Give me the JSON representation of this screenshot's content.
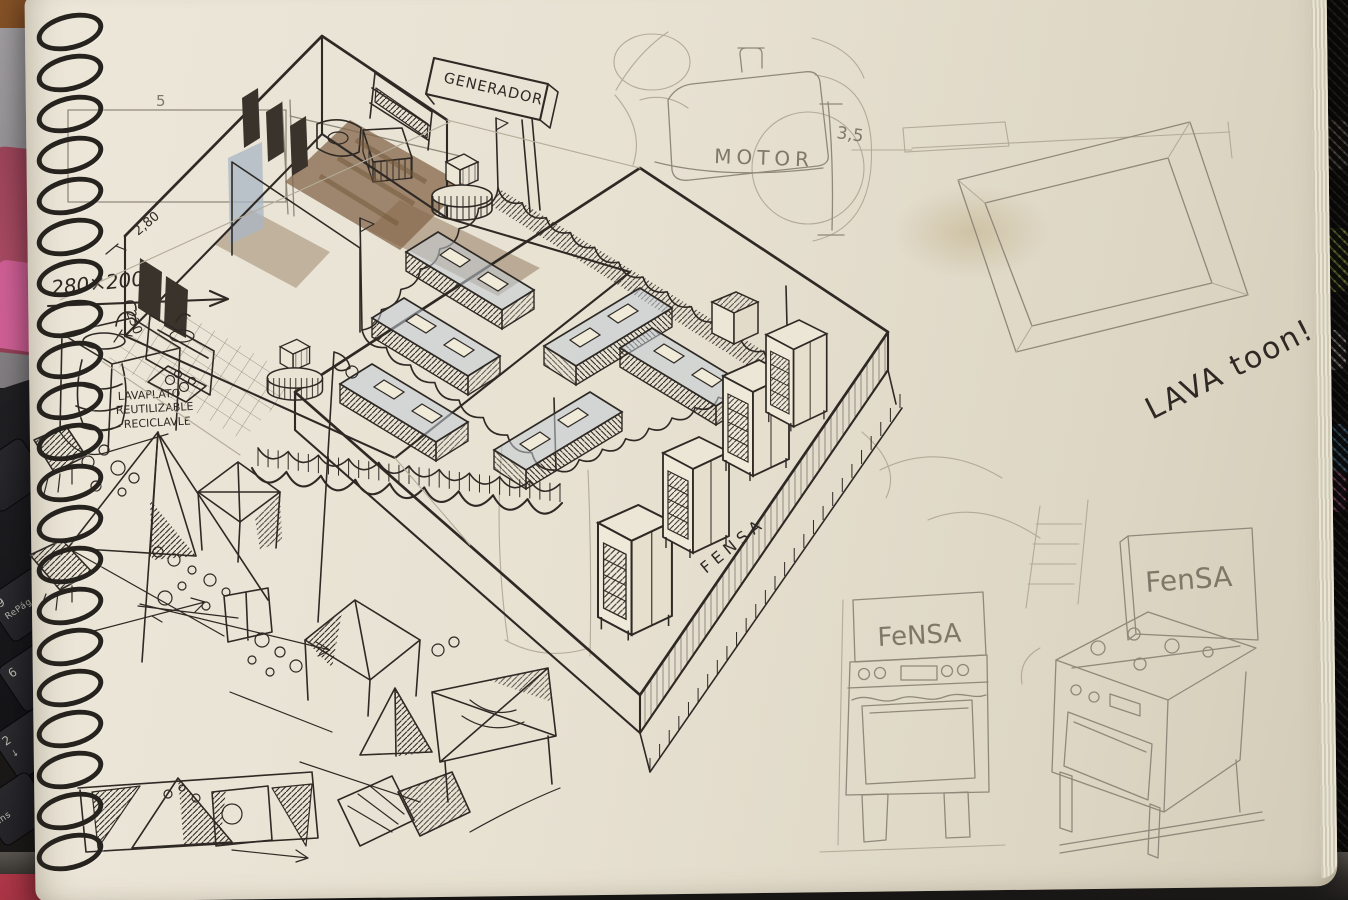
{
  "photo": {
    "keyboard": {
      "keys": [
        {
          "top": "9",
          "bottom": "RePág"
        },
        {
          "top": "6",
          "bottom": ""
        },
        {
          "top": "2",
          "bottom": "↓"
        },
        {
          "top": "",
          "bottom": "Ins"
        }
      ]
    },
    "colors": {
      "page": "#e7e1d2",
      "ink": "#2e2924",
      "pencil": "#8f897b",
      "marker_brown": "#84664a",
      "marker_blue": "#a9b6c4",
      "wood_shelf": "#7b4d24",
      "pink_object": "#a84a62",
      "keyboard": "#1b1b1e",
      "mesh_green": "#9dab3f",
      "desk": "#2a2725"
    }
  },
  "sketch": {
    "labels": {
      "generator_sign": "GENERADOR",
      "motor": "MOTOR",
      "motor_dim": "3,5",
      "plan_dim": "280×200",
      "rect_dim": "5",
      "height_dim": "2,80",
      "side_dim": "230",
      "washer_note": [
        "LAVAPLATO",
        "REUTILIZABLE",
        "RECICLAVLE"
      ],
      "exclaim": "LAVA toon!",
      "platform_brand": "FENSA",
      "stove_front_brand": "FeNSA",
      "stove_iso_brand": "FenSA"
    }
  }
}
